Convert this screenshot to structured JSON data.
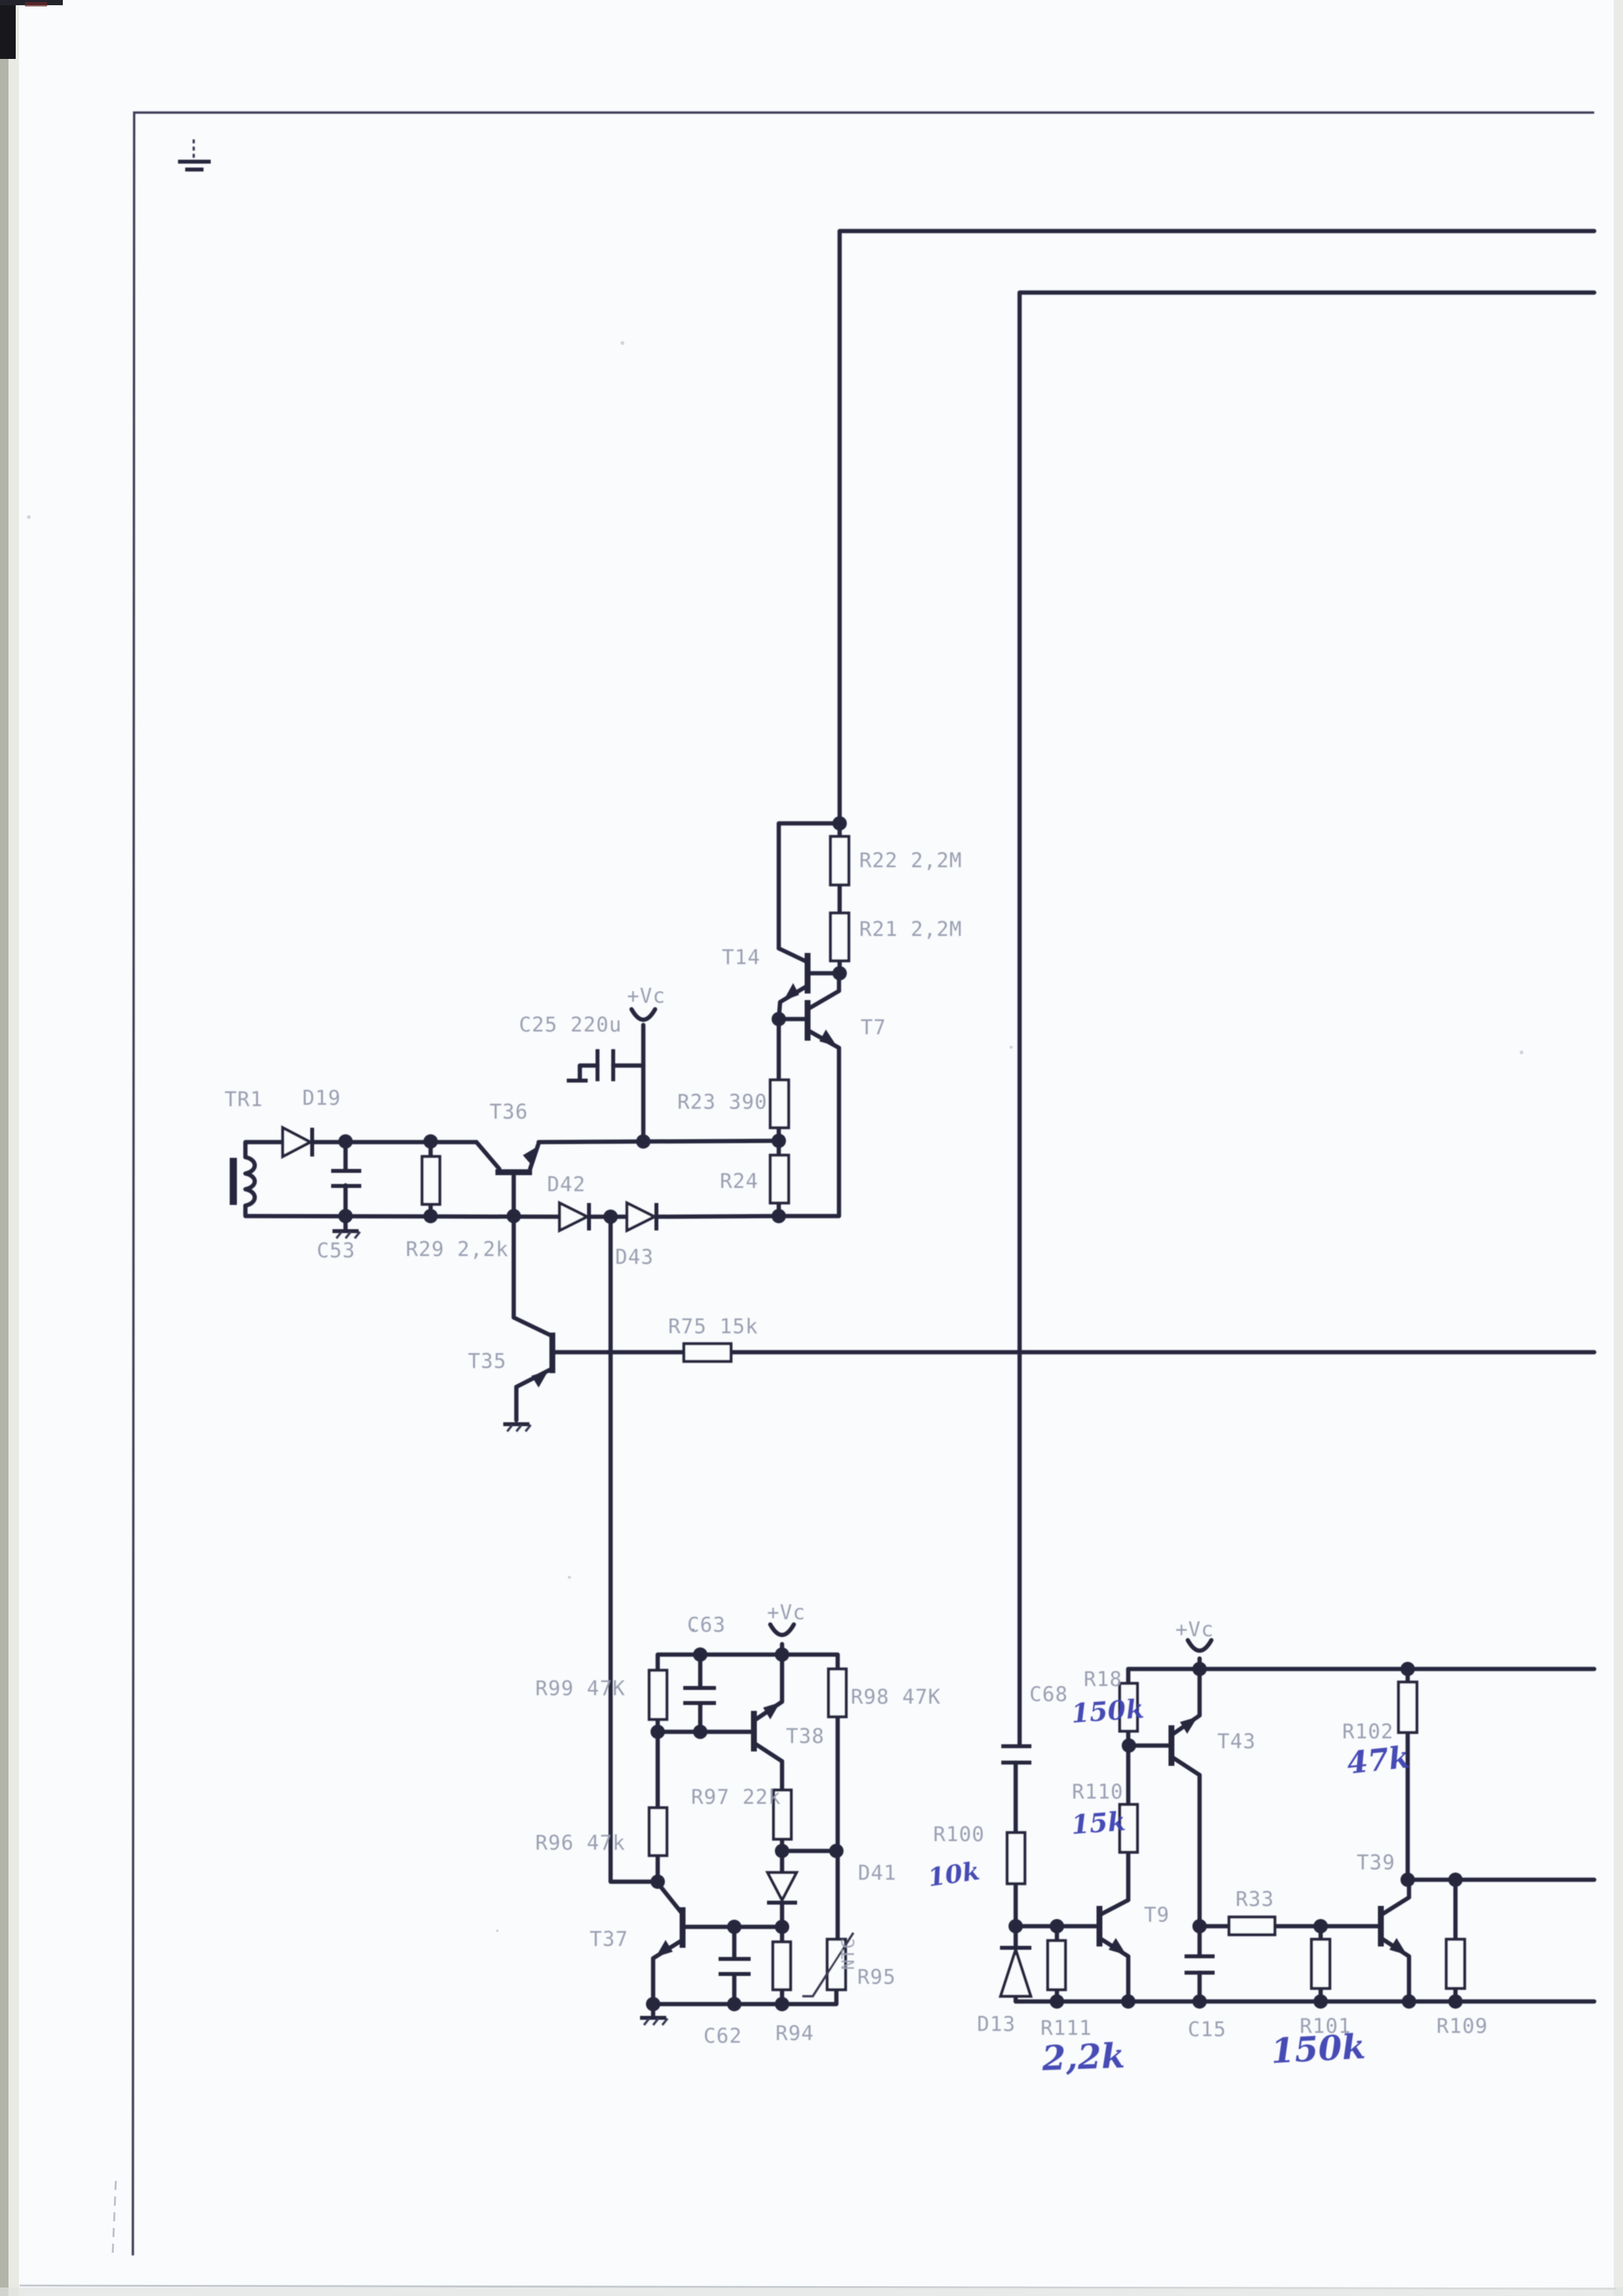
{
  "page": {
    "background": "#fafbfd",
    "ink": "#26263e",
    "label_ink": "#9298ac",
    "handwriting_ink": "#3c41b2",
    "kind": "scanned schematic sheet"
  },
  "labels": {
    "tr1": "TR1",
    "d19": "D19",
    "c53": "C53",
    "r29": "R29 2,2k",
    "t36": "T36",
    "c25": "C25 220u",
    "vc_top": "+Vc",
    "t14": "T14",
    "t7": "T7",
    "r22": "R22 2,2M",
    "r21": "R21 2,2M",
    "r23": "R23 390",
    "r24": "R24",
    "d42": "D42",
    "d43": "D43",
    "t35": "T35",
    "r75": "R75 15k",
    "c63": "C63",
    "vc_mid": "+Vc",
    "r99": "R99 47K",
    "r98": "R98 47K",
    "t38": "T38",
    "r97": "R97 22k",
    "r96": "R96 47k",
    "d41": "D41",
    "t37": "T37",
    "ntc": "NTC",
    "r95": "R95",
    "c62": "C62",
    "r94": "R94",
    "c68": "C68",
    "vc_right": "+Vc",
    "r18": "R18",
    "t43": "T43",
    "r110": "R110",
    "r100": "R100",
    "d13": "D13",
    "r111": "R111",
    "t9": "T9",
    "c15": "C15",
    "r33": "R33",
    "r101": "R101",
    "r102": "R102",
    "t39": "T39",
    "r109": "R109"
  },
  "annotations": {
    "r18_value": "150k",
    "r110_value": "15k",
    "r100_value": "10k",
    "r111_value": "2,2k",
    "r101_value": "150k",
    "r102_value": "47k"
  }
}
